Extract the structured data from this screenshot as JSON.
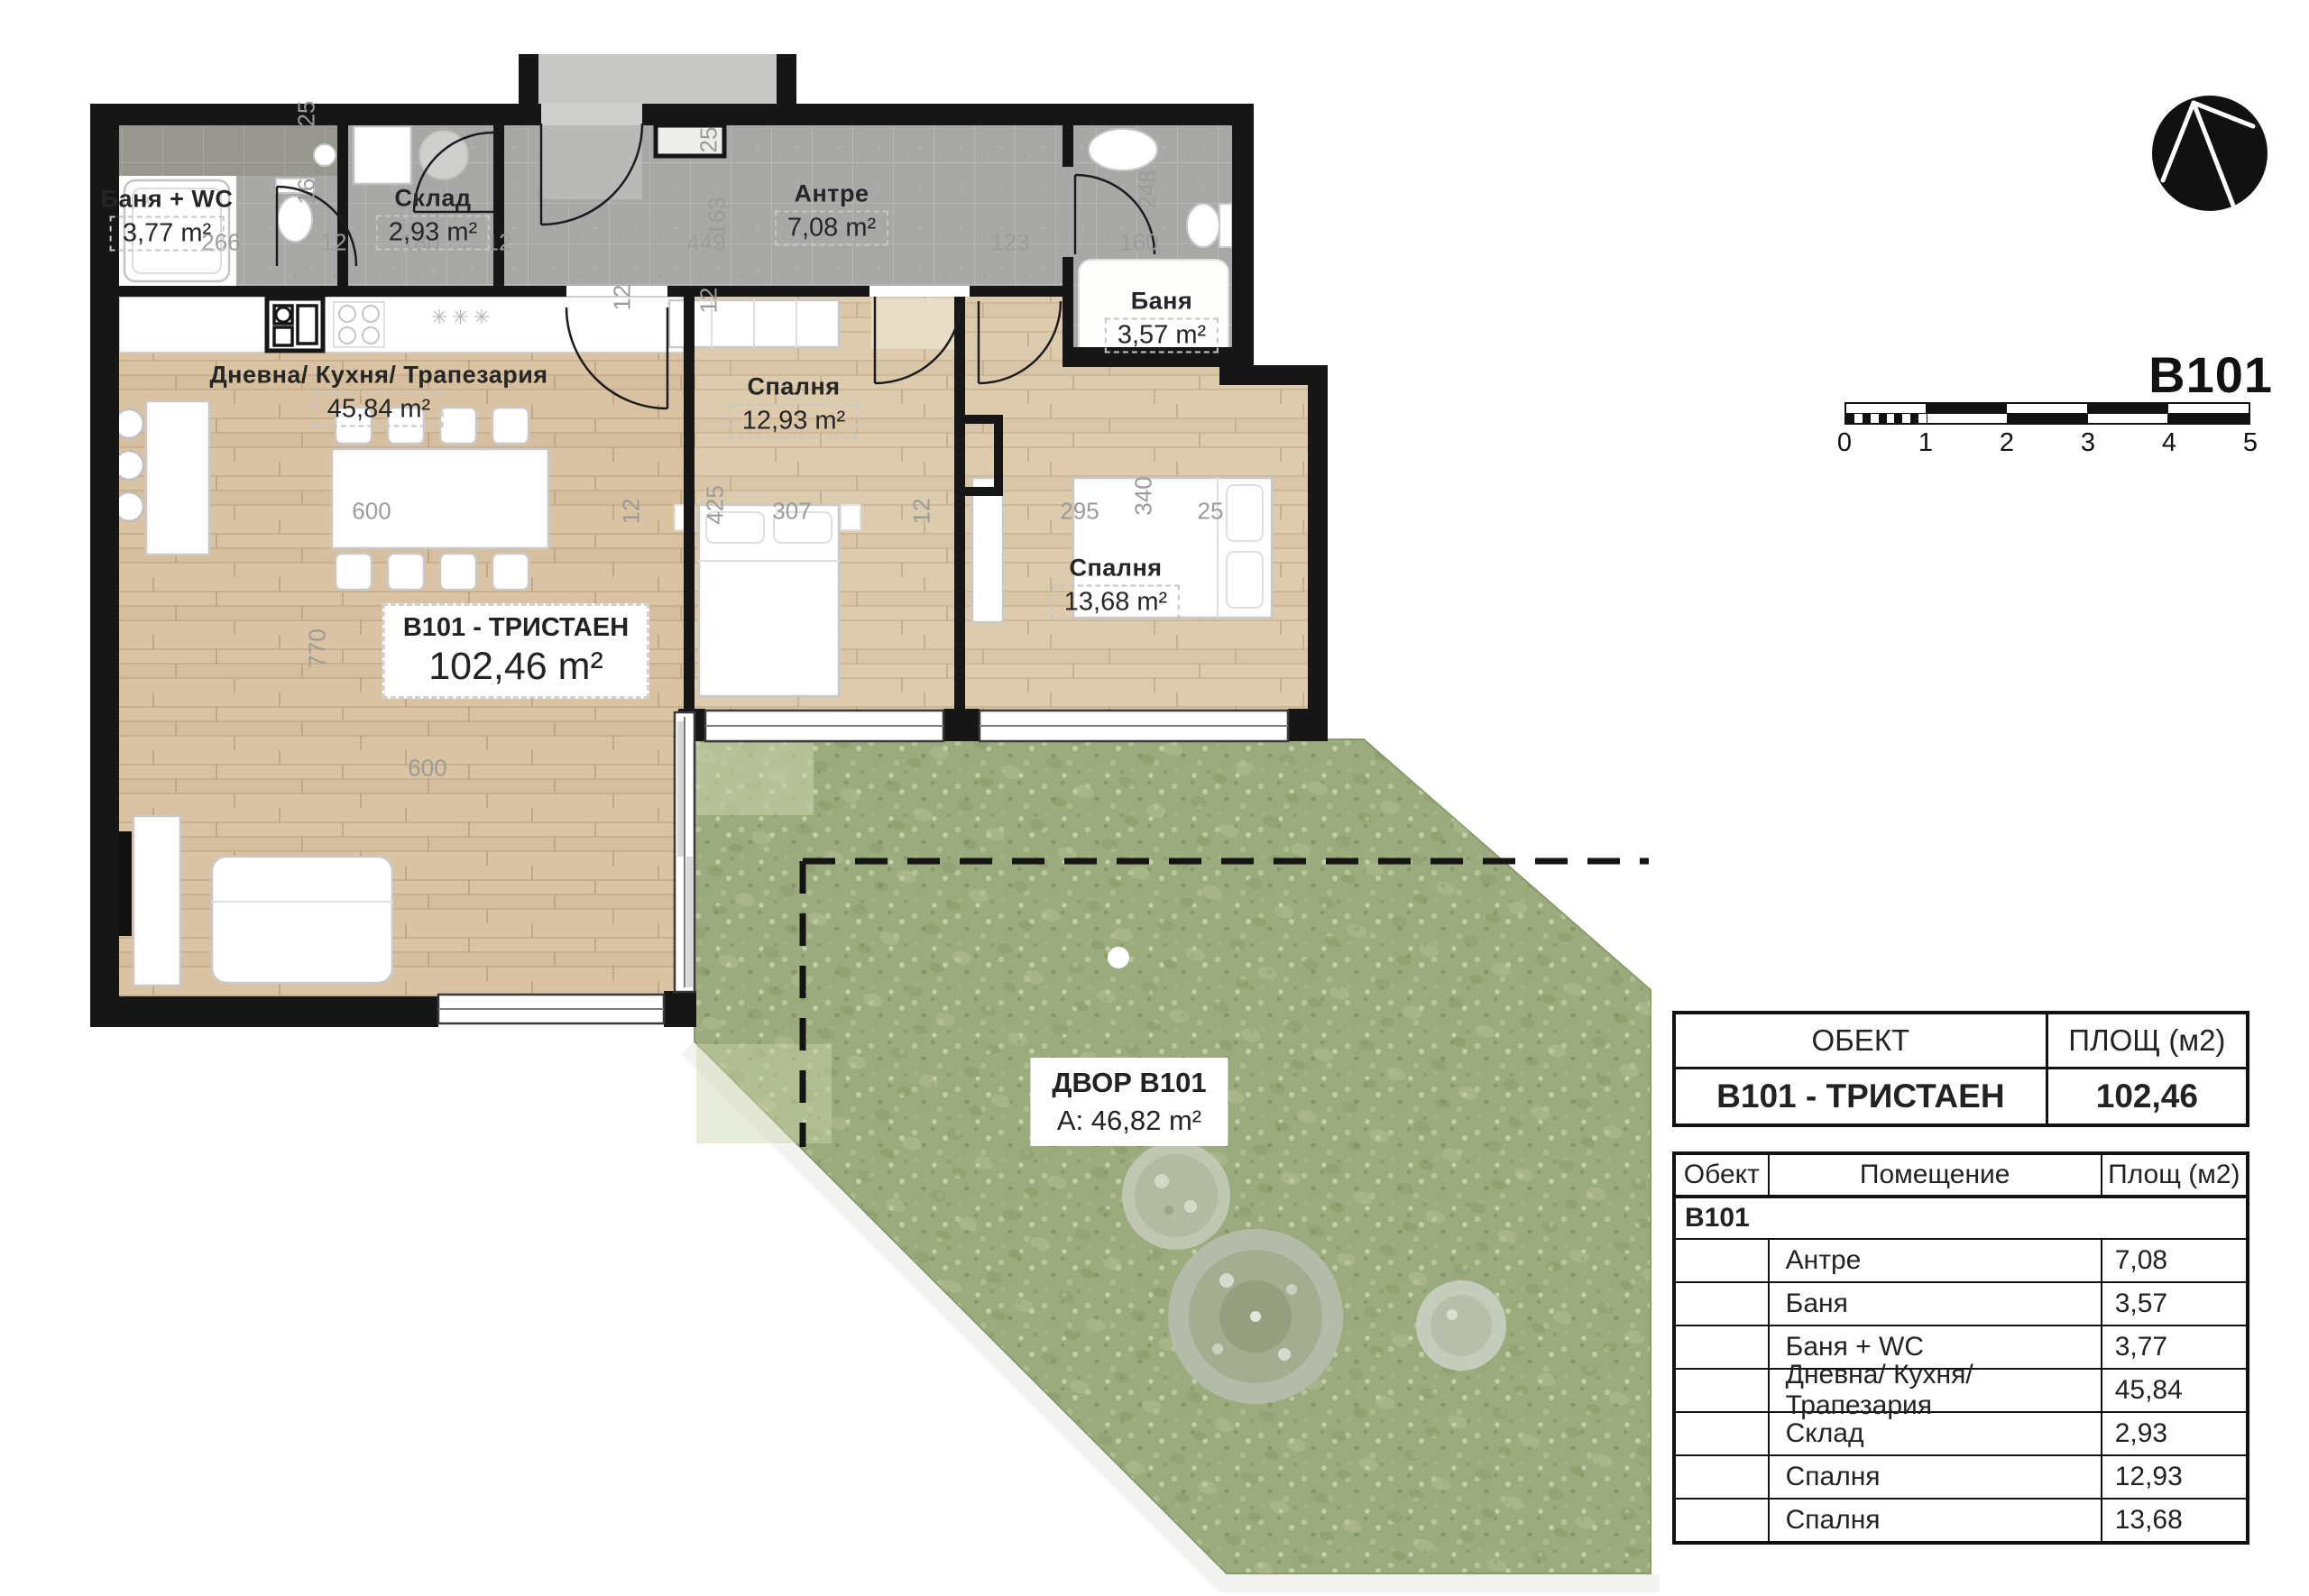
{
  "brand": {
    "title": "B101"
  },
  "scale_bar": {
    "ticks": [
      "0",
      "1",
      "2",
      "3",
      "4",
      "5"
    ]
  },
  "rooms": [
    {
      "name": "Баня + WC",
      "area": "3,77 m²"
    },
    {
      "name": "Склад",
      "area": "2,93 m²"
    },
    {
      "name": "Антре",
      "area": "7,08 m²"
    },
    {
      "name": "Баня",
      "area": "3,57 m²"
    },
    {
      "name": "Дневна/ Кухня/ Трапезария",
      "area": "45,84 m²"
    },
    {
      "name": "Спалня",
      "area": "12,93 m²"
    },
    {
      "name": "Спалня",
      "area": "13,68 m²"
    }
  ],
  "unit_label": {
    "title": "B101 - ТРИСТАЕН",
    "area": "102,46 m²"
  },
  "yard_label": {
    "title": "ДВОР B101",
    "area": "A: 46,82 m²"
  },
  "kitchen_marker": "✳✳✳",
  "dims": [
    "266",
    "12",
    "180",
    "12",
    "449",
    "123",
    "160",
    "25",
    "163",
    "25",
    "163",
    "12",
    "248",
    "425",
    "307",
    "12",
    "12",
    "295",
    "340",
    "25",
    "770",
    "600",
    "600",
    "12"
  ],
  "summary_table": {
    "col_object": "ОБЕКТ",
    "col_area": "ПЛОЩ (м2)",
    "row": {
      "object": "B101 - ТРИСТАЕН",
      "area": "102,46"
    }
  },
  "rooms_table": {
    "col_object": "Обект",
    "col_room": "Помещение",
    "col_area": "Площ (м2)",
    "group": "B101",
    "rows": [
      {
        "room": "Антре",
        "area": "7,08"
      },
      {
        "room": "Баня",
        "area": "3,57"
      },
      {
        "room": "Баня + WC",
        "area": "3,77"
      },
      {
        "room": "Дневна/ Кухня/ Трапезария",
        "area": "45,84"
      },
      {
        "room": "Склад",
        "area": "2,93"
      },
      {
        "room": "Спалня",
        "area": "12,93"
      },
      {
        "room": "Спалня",
        "area": "13,68"
      }
    ]
  },
  "colors": {
    "wall": "#161616",
    "wood": "#d9c3a3",
    "tile": "#a8a8a6",
    "grass": "#9cab7d"
  }
}
